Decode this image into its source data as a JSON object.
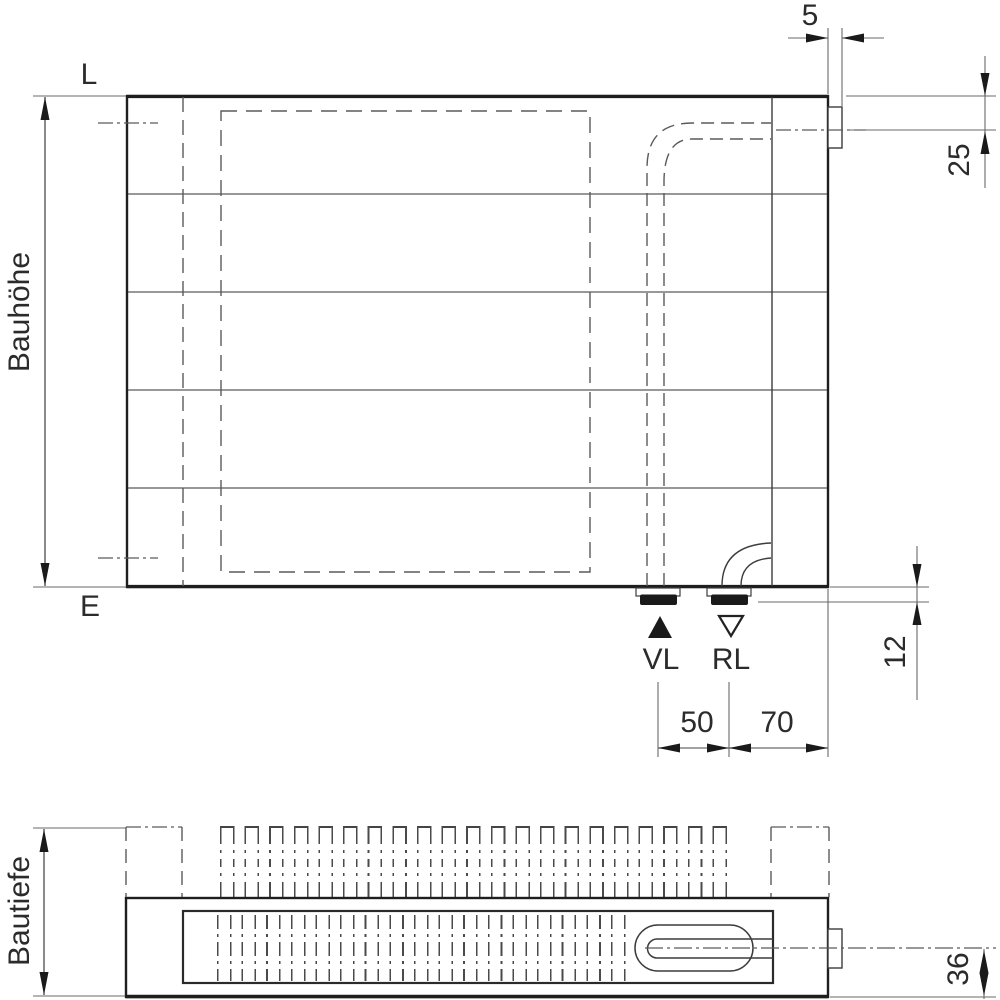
{
  "front_view": {
    "top_reference_label": "L",
    "bottom_reference_label": "E",
    "height_label": "Bauhöhe",
    "flow_label": "VL",
    "return_label": "RL",
    "dims": {
      "side_tab_width": "5",
      "side_connection_offset": "25",
      "bottom_connection_drop": "12",
      "vl_rl_spacing": "50",
      "rl_to_right_edge": "70"
    }
  },
  "plan_view": {
    "depth_label": "Bautiefe",
    "dims": {
      "connection_axis_to_front": "36"
    }
  },
  "colors": {
    "line_strong": "#1e1e1e",
    "line_medium": "#3c3c3c",
    "line_thin": "#5a5a5a",
    "text": "#2b2b2b"
  }
}
